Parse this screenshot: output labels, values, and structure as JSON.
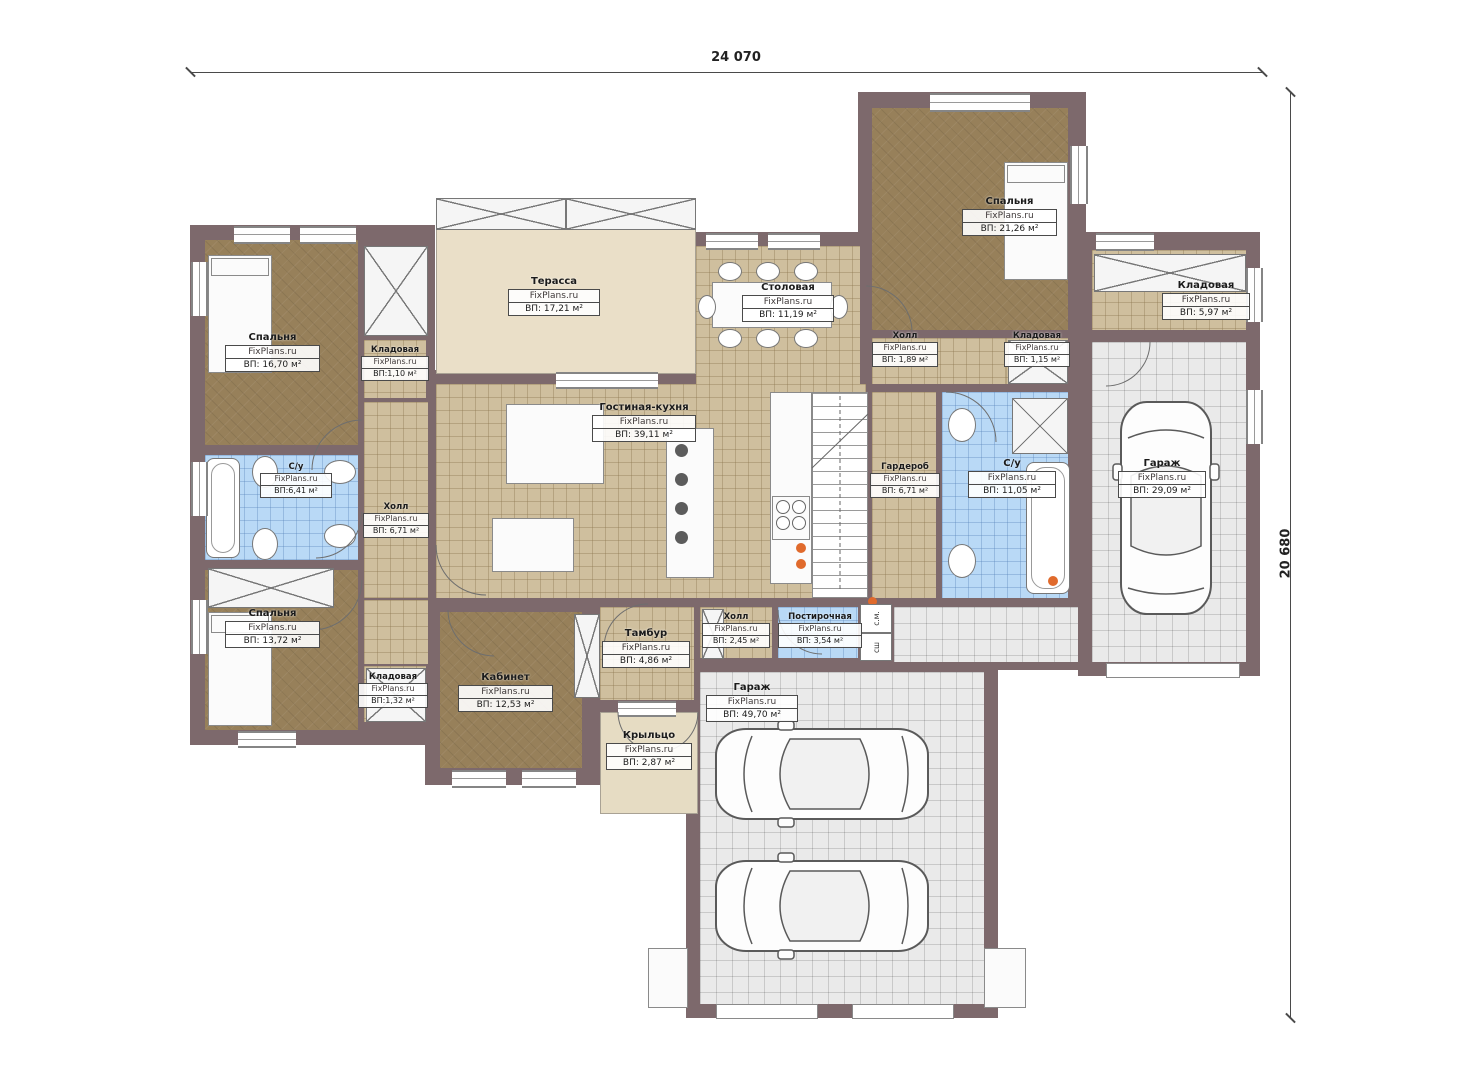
{
  "watermark": "FixPlans.ru",
  "dimensions": {
    "width": "24 070",
    "height": "20 680"
  },
  "colors": {
    "wall": "#7d696c",
    "floor_wood": "#97805a",
    "floor_tile": "#cfbf9e",
    "floor_bath": "#b9d9f6",
    "floor_garage": "#eaeaea",
    "terrace": "#eadfc8",
    "accent_orange": "#e06a2c"
  },
  "rooms": [
    {
      "name": "Спальня",
      "area": "ВП: 16,70 м²"
    },
    {
      "name": "Кладовая",
      "area": "ВП:1,10 м²"
    },
    {
      "name": "С/у",
      "area": "ВП:6,41 м²"
    },
    {
      "name": "Холл",
      "area": "ВП: 6,71 м²"
    },
    {
      "name": "Спальня",
      "area": "ВП: 13,72 м²"
    },
    {
      "name": "Кладовая",
      "area": "ВП:1,32 м²"
    },
    {
      "name": "Кабинет",
      "area": "ВП: 12,53 м²"
    },
    {
      "name": "Терасса",
      "area": "ВП: 17,21 м²"
    },
    {
      "name": "Гостиная-кухня",
      "area": "ВП: 39,11 м²"
    },
    {
      "name": "Столовая",
      "area": "ВП: 11,19 м²"
    },
    {
      "name": "Тамбур",
      "area": "ВП: 4,86 м²"
    },
    {
      "name": "Крыльцо",
      "area": "ВП: 2,87 м²"
    },
    {
      "name": "Спальня",
      "area": "ВП: 21,26 м²"
    },
    {
      "name": "Холл",
      "area": "ВП: 1,89 м²"
    },
    {
      "name": "Кладовая",
      "area": "ВП: 1,15 м²"
    },
    {
      "name": "Кладовая",
      "area": "ВП: 5,97 м²"
    },
    {
      "name": "Гардероб",
      "area": "ВП: 6,71 м²"
    },
    {
      "name": "С/у",
      "area": "ВП: 11,05 м²"
    },
    {
      "name": "Гараж",
      "area": "ВП: 29,09 м²"
    },
    {
      "name": "Холл",
      "area": "ВП: 2,45 м²"
    },
    {
      "name": "Постирочная",
      "area": "ВП: 3,54 м²"
    },
    {
      "name": "Гараж",
      "area": "ВП: 49,70 м²"
    }
  ],
  "appliances": [
    {
      "label": "с.м."
    },
    {
      "label": "сш"
    }
  ]
}
